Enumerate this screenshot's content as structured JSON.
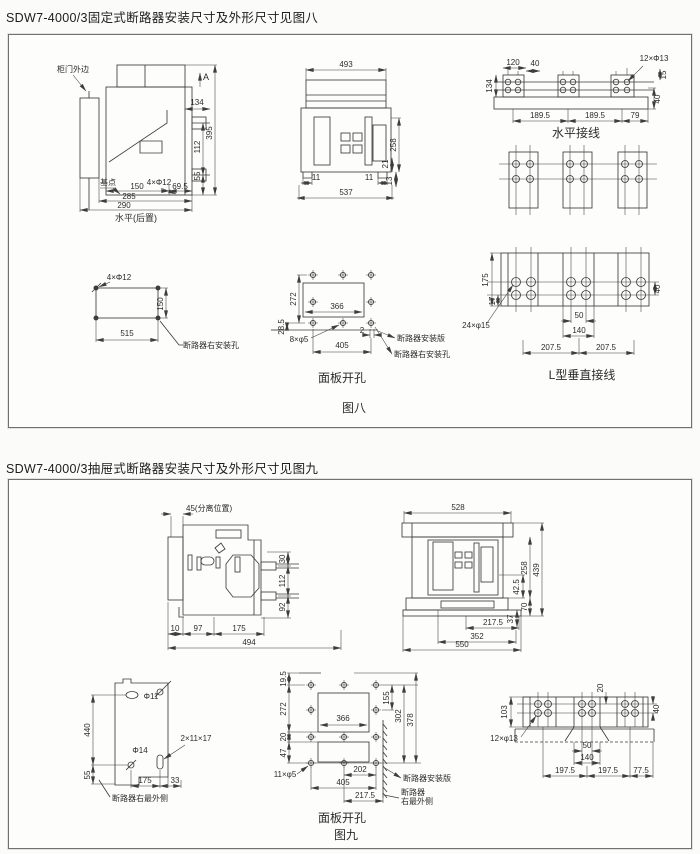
{
  "sections": {
    "fig8": {
      "title": "SDW7-4000/3固定式断路器安装尺寸及外形尺寸见图八",
      "caption": "图八"
    },
    "fig9": {
      "title": "SDW7-4000/3抽屉式断路器安装尺寸及外形尺寸见图九",
      "caption": "图九"
    }
  },
  "colors": {
    "ink": "#3d3d3d",
    "paper": "#fbfbf9"
  },
  "fig8_labels": [
    {
      "t": "柜门外边",
      "x": 64,
      "y": 37
    },
    {
      "t": "A",
      "x": 197,
      "y": 45,
      "s": 9
    },
    {
      "t": "134",
      "x": 188,
      "y": 70
    },
    {
      "t": "395",
      "x": 203,
      "y": 98,
      "r": -90
    },
    {
      "t": "112",
      "x": 191,
      "y": 112,
      "r": -90
    },
    {
      "t": "55",
      "x": 191,
      "y": 141,
      "r": -90
    },
    {
      "t": "基点",
      "x": 99,
      "y": 150
    },
    {
      "t": "4×Φ12",
      "x": 150,
      "y": 150
    },
    {
      "t": "150",
      "x": 128,
      "y": 154
    },
    {
      "t": "69.5",
      "x": 171,
      "y": 154
    },
    {
      "t": "285",
      "x": 120,
      "y": 164
    },
    {
      "t": "290",
      "x": 115,
      "y": 173
    },
    {
      "t": "水平(后置)",
      "x": 127,
      "y": 186,
      "s": 9,
      "n": "drawing-caption"
    },
    {
      "t": "493",
      "x": 337,
      "y": 32
    },
    {
      "t": "258",
      "x": 387,
      "y": 110,
      "r": -90
    },
    {
      "t": "21",
      "x": 379,
      "y": 129,
      "r": -90
    },
    {
      "t": "13",
      "x": 383,
      "y": 146,
      "r": -90
    },
    {
      "t": "11",
      "x": 307,
      "y": 145
    },
    {
      "t": "11",
      "x": 360,
      "y": 145
    },
    {
      "t": "537",
      "x": 337,
      "y": 160
    },
    {
      "t": "120",
      "x": 504,
      "y": 30
    },
    {
      "t": "40",
      "x": 526,
      "y": 31
    },
    {
      "t": "12×Φ13",
      "x": 645,
      "y": 26
    },
    {
      "t": "15",
      "x": 657,
      "y": 40,
      "r": -90
    },
    {
      "t": "134",
      "x": 483,
      "y": 51,
      "r": -90
    },
    {
      "t": "40",
      "x": 651,
      "y": 64,
      "r": -90
    },
    {
      "t": "189.5",
      "x": 531,
      "y": 83
    },
    {
      "t": "189.5",
      "x": 586,
      "y": 83
    },
    {
      "t": "79",
      "x": 626,
      "y": 83
    },
    {
      "t": "水平接线",
      "x": 567,
      "y": 102,
      "s": 12,
      "n": "drawing-caption"
    },
    {
      "t": "175",
      "x": 479,
      "y": 245,
      "r": -90
    },
    {
      "t": "17",
      "x": 486,
      "y": 266,
      "r": -90
    },
    {
      "t": "24×φ15",
      "x": 467,
      "y": 293
    },
    {
      "t": "40",
      "x": 651,
      "y": 254,
      "r": -90
    },
    {
      "t": "50",
      "x": 570,
      "y": 283
    },
    {
      "t": "140",
      "x": 570,
      "y": 298
    },
    {
      "t": "207.5",
      "x": 542,
      "y": 315
    },
    {
      "t": "207.5",
      "x": 597,
      "y": 315
    },
    {
      "t": "L型垂直接线",
      "x": 573,
      "y": 344,
      "s": 12,
      "n": "drawing-caption"
    },
    {
      "t": "4×Φ12",
      "x": 110,
      "y": 245
    },
    {
      "t": "150",
      "x": 154,
      "y": 269,
      "r": -90
    },
    {
      "t": "515",
      "x": 118,
      "y": 301
    },
    {
      "t": "断路器右安装孔",
      "x": 174,
      "y": 313,
      "a": "s"
    },
    {
      "t": "272",
      "x": 287,
      "y": 264,
      "r": -90
    },
    {
      "t": "28.5",
      "x": 275,
      "y": 292,
      "r": -90
    },
    {
      "t": "366",
      "x": 328,
      "y": 274
    },
    {
      "t": "8×φ5",
      "x": 290,
      "y": 307
    },
    {
      "t": "2",
      "x": 353,
      "y": 298
    },
    {
      "t": "405",
      "x": 333,
      "y": 313
    },
    {
      "t": "断路器安装版",
      "x": 388,
      "y": 306,
      "a": "s"
    },
    {
      "t": "断路器右安装孔",
      "x": 385,
      "y": 322,
      "a": "s"
    },
    {
      "t": "面板开孔",
      "x": 333,
      "y": 347,
      "s": 12,
      "n": "drawing-caption"
    },
    {
      "t": "图八",
      "x": 345,
      "y": 377,
      "s": 12,
      "n": "figure-caption"
    }
  ],
  "fig9_labels": [
    {
      "t": "45(分离位置)",
      "x": 177,
      "y": 31,
      "a": "s"
    },
    {
      "t": "30",
      "x": 276,
      "y": 79,
      "r": -90
    },
    {
      "t": "112",
      "x": 276,
      "y": 101,
      "r": -90
    },
    {
      "t": "92",
      "x": 276,
      "y": 127,
      "r": -90
    },
    {
      "t": "10",
      "x": 166,
      "y": 151
    },
    {
      "t": "97",
      "x": 189,
      "y": 151
    },
    {
      "t": "175",
      "x": 230,
      "y": 151
    },
    {
      "t": "494",
      "x": 240,
      "y": 165
    },
    {
      "t": "528",
      "x": 449,
      "y": 30
    },
    {
      "t": "258",
      "x": 518,
      "y": 88,
      "r": -90
    },
    {
      "t": "439",
      "x": 530,
      "y": 90,
      "r": -90
    },
    {
      "t": "42.5",
      "x": 510,
      "y": 107,
      "r": -90
    },
    {
      "t": "70",
      "x": 518,
      "y": 127,
      "r": -90
    },
    {
      "t": "37",
      "x": 504,
      "y": 139,
      "r": -90
    },
    {
      "t": "217.5",
      "x": 484,
      "y": 145
    },
    {
      "t": "352",
      "x": 468,
      "y": 159
    },
    {
      "t": "550",
      "x": 453,
      "y": 167
    },
    {
      "t": "Φ11",
      "x": 142,
      "y": 219
    },
    {
      "t": "440",
      "x": 81,
      "y": 250,
      "r": -90
    },
    {
      "t": "Φ14",
      "x": 131,
      "y": 273
    },
    {
      "t": "2×11×17",
      "x": 187,
      "y": 261
    },
    {
      "t": "55",
      "x": 81,
      "y": 295,
      "r": -90
    },
    {
      "t": "175",
      "x": 136,
      "y": 303
    },
    {
      "t": "33",
      "x": 166,
      "y": 303
    },
    {
      "t": "断路器右最外侧",
      "x": 103,
      "y": 321,
      "a": "s"
    },
    {
      "t": "19.5",
      "x": 277,
      "y": 199,
      "r": -90
    },
    {
      "t": "272",
      "x": 277,
      "y": 229,
      "r": -90
    },
    {
      "t": "20",
      "x": 277,
      "y": 257,
      "r": -90
    },
    {
      "t": "47",
      "x": 277,
      "y": 273,
      "r": -90
    },
    {
      "t": "155",
      "x": 380,
      "y": 218,
      "r": -90
    },
    {
      "t": "302",
      "x": 392,
      "y": 236,
      "r": -90
    },
    {
      "t": "378",
      "x": 404,
      "y": 240,
      "r": -90
    },
    {
      "t": "366",
      "x": 334,
      "y": 241
    },
    {
      "t": "202",
      "x": 351,
      "y": 292
    },
    {
      "t": "405",
      "x": 334,
      "y": 305
    },
    {
      "t": "217.5",
      "x": 356,
      "y": 318
    },
    {
      "t": "11×φ5",
      "x": 276,
      "y": 297
    },
    {
      "t": "断路器安装版",
      "x": 394,
      "y": 301,
      "a": "s"
    },
    {
      "t": "断路器",
      "x": 392,
      "y": 315,
      "a": "s"
    },
    {
      "t": "右最外侧",
      "x": 392,
      "y": 324,
      "a": "s"
    },
    {
      "t": "面板开孔",
      "x": 333,
      "y": 342,
      "s": 12,
      "n": "drawing-caption"
    },
    {
      "t": "图九",
      "x": 337,
      "y": 359,
      "s": 12,
      "n": "figure-caption"
    },
    {
      "t": "20",
      "x": 594,
      "y": 208,
      "r": -90
    },
    {
      "t": "103",
      "x": 498,
      "y": 232,
      "r": -90
    },
    {
      "t": "40",
      "x": 650,
      "y": 229,
      "r": -90
    },
    {
      "t": "12×φ13",
      "x": 495,
      "y": 261
    },
    {
      "t": "50",
      "x": 578,
      "y": 268
    },
    {
      "t": "140",
      "x": 578,
      "y": 280
    },
    {
      "t": "197.5",
      "x": 556,
      "y": 293
    },
    {
      "t": "197.5",
      "x": 599,
      "y": 293
    },
    {
      "t": "77.5",
      "x": 632,
      "y": 293
    }
  ]
}
